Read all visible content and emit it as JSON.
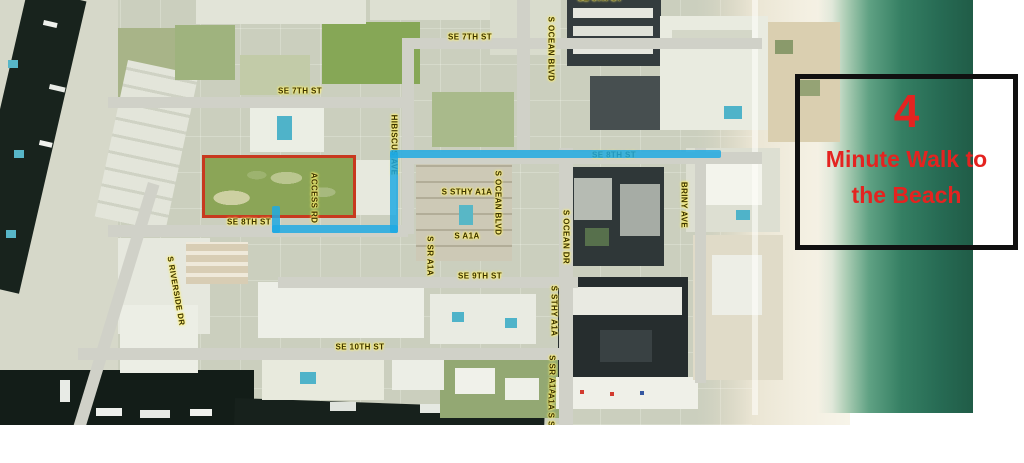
{
  "annotation": {
    "headline_number": "4",
    "line1": "Minute Walk to",
    "line2": "the Beach",
    "text_color": "#e42320",
    "box_border_color": "#101010"
  },
  "map": {
    "street_labels": [
      {
        "text": "SE 6TH CT",
        "x": 600,
        "y": -2,
        "rot": 0
      },
      {
        "text": "SE 7TH ST",
        "x": 300,
        "y": 91,
        "rot": 0
      },
      {
        "text": "SE 7TH ST",
        "x": 470,
        "y": 37,
        "rot": 0
      },
      {
        "text": "SE 8TH ST",
        "x": 249,
        "y": 222,
        "rot": 0
      },
      {
        "text": "SE 8TH ST",
        "x": 614,
        "y": 155,
        "rot": 0
      },
      {
        "text": "SE 9TH ST",
        "x": 480,
        "y": 276,
        "rot": 0
      },
      {
        "text": "SE 10TH ST",
        "x": 360,
        "y": 347,
        "rot": 0
      },
      {
        "text": "S STHY A1A",
        "x": 467,
        "y": 192,
        "rot": 0
      },
      {
        "text": "S A1A",
        "x": 467,
        "y": 236,
        "rot": 0
      },
      {
        "text": "S OCEAN BLVD",
        "x": 551,
        "y": 49,
        "rot": 90
      },
      {
        "text": "S OCEAN BLVD",
        "x": 498,
        "y": 203,
        "rot": 90
      },
      {
        "text": "S OCEAN DR",
        "x": 566,
        "y": 237,
        "rot": 90
      },
      {
        "text": "S STHY A1A",
        "x": 554,
        "y": 311,
        "rot": 90
      },
      {
        "text": "S SR A1A",
        "x": 552,
        "y": 375,
        "rot": 90
      },
      {
        "text": "A1A S SR",
        "x": 551,
        "y": 413,
        "rot": 90
      },
      {
        "text": "S SR A1A",
        "x": 430,
        "y": 256,
        "rot": 90
      },
      {
        "text": "HIBISCUS AVE",
        "x": 394,
        "y": 145,
        "rot": 90
      },
      {
        "text": "ACCESS RD",
        "x": 314,
        "y": 198,
        "rot": 90
      },
      {
        "text": "BRINY AVE",
        "x": 684,
        "y": 205,
        "rot": 90
      },
      {
        "text": "S RIVERSIDE DR",
        "x": 176,
        "y": 291,
        "rot": 80
      }
    ],
    "route": {
      "color": "#1ea9e2",
      "segments": [
        {
          "x": 272,
          "y": 206,
          "w": 8,
          "h": 27
        },
        {
          "x": 272,
          "y": 225,
          "w": 126,
          "h": 8
        },
        {
          "x": 390,
          "y": 152,
          "w": 8,
          "h": 81
        },
        {
          "x": 390,
          "y": 150,
          "w": 331,
          "h": 8
        }
      ]
    },
    "highlighted_parcel": {
      "outline_color": "#c8391f"
    },
    "colors": {
      "ocean": "#2d7a5e",
      "sand": "#efeadb",
      "canal": "#18231d",
      "route_blue": "#1ea9e2",
      "label_text": "#3a3300",
      "label_halo": "#ffef6e"
    }
  }
}
